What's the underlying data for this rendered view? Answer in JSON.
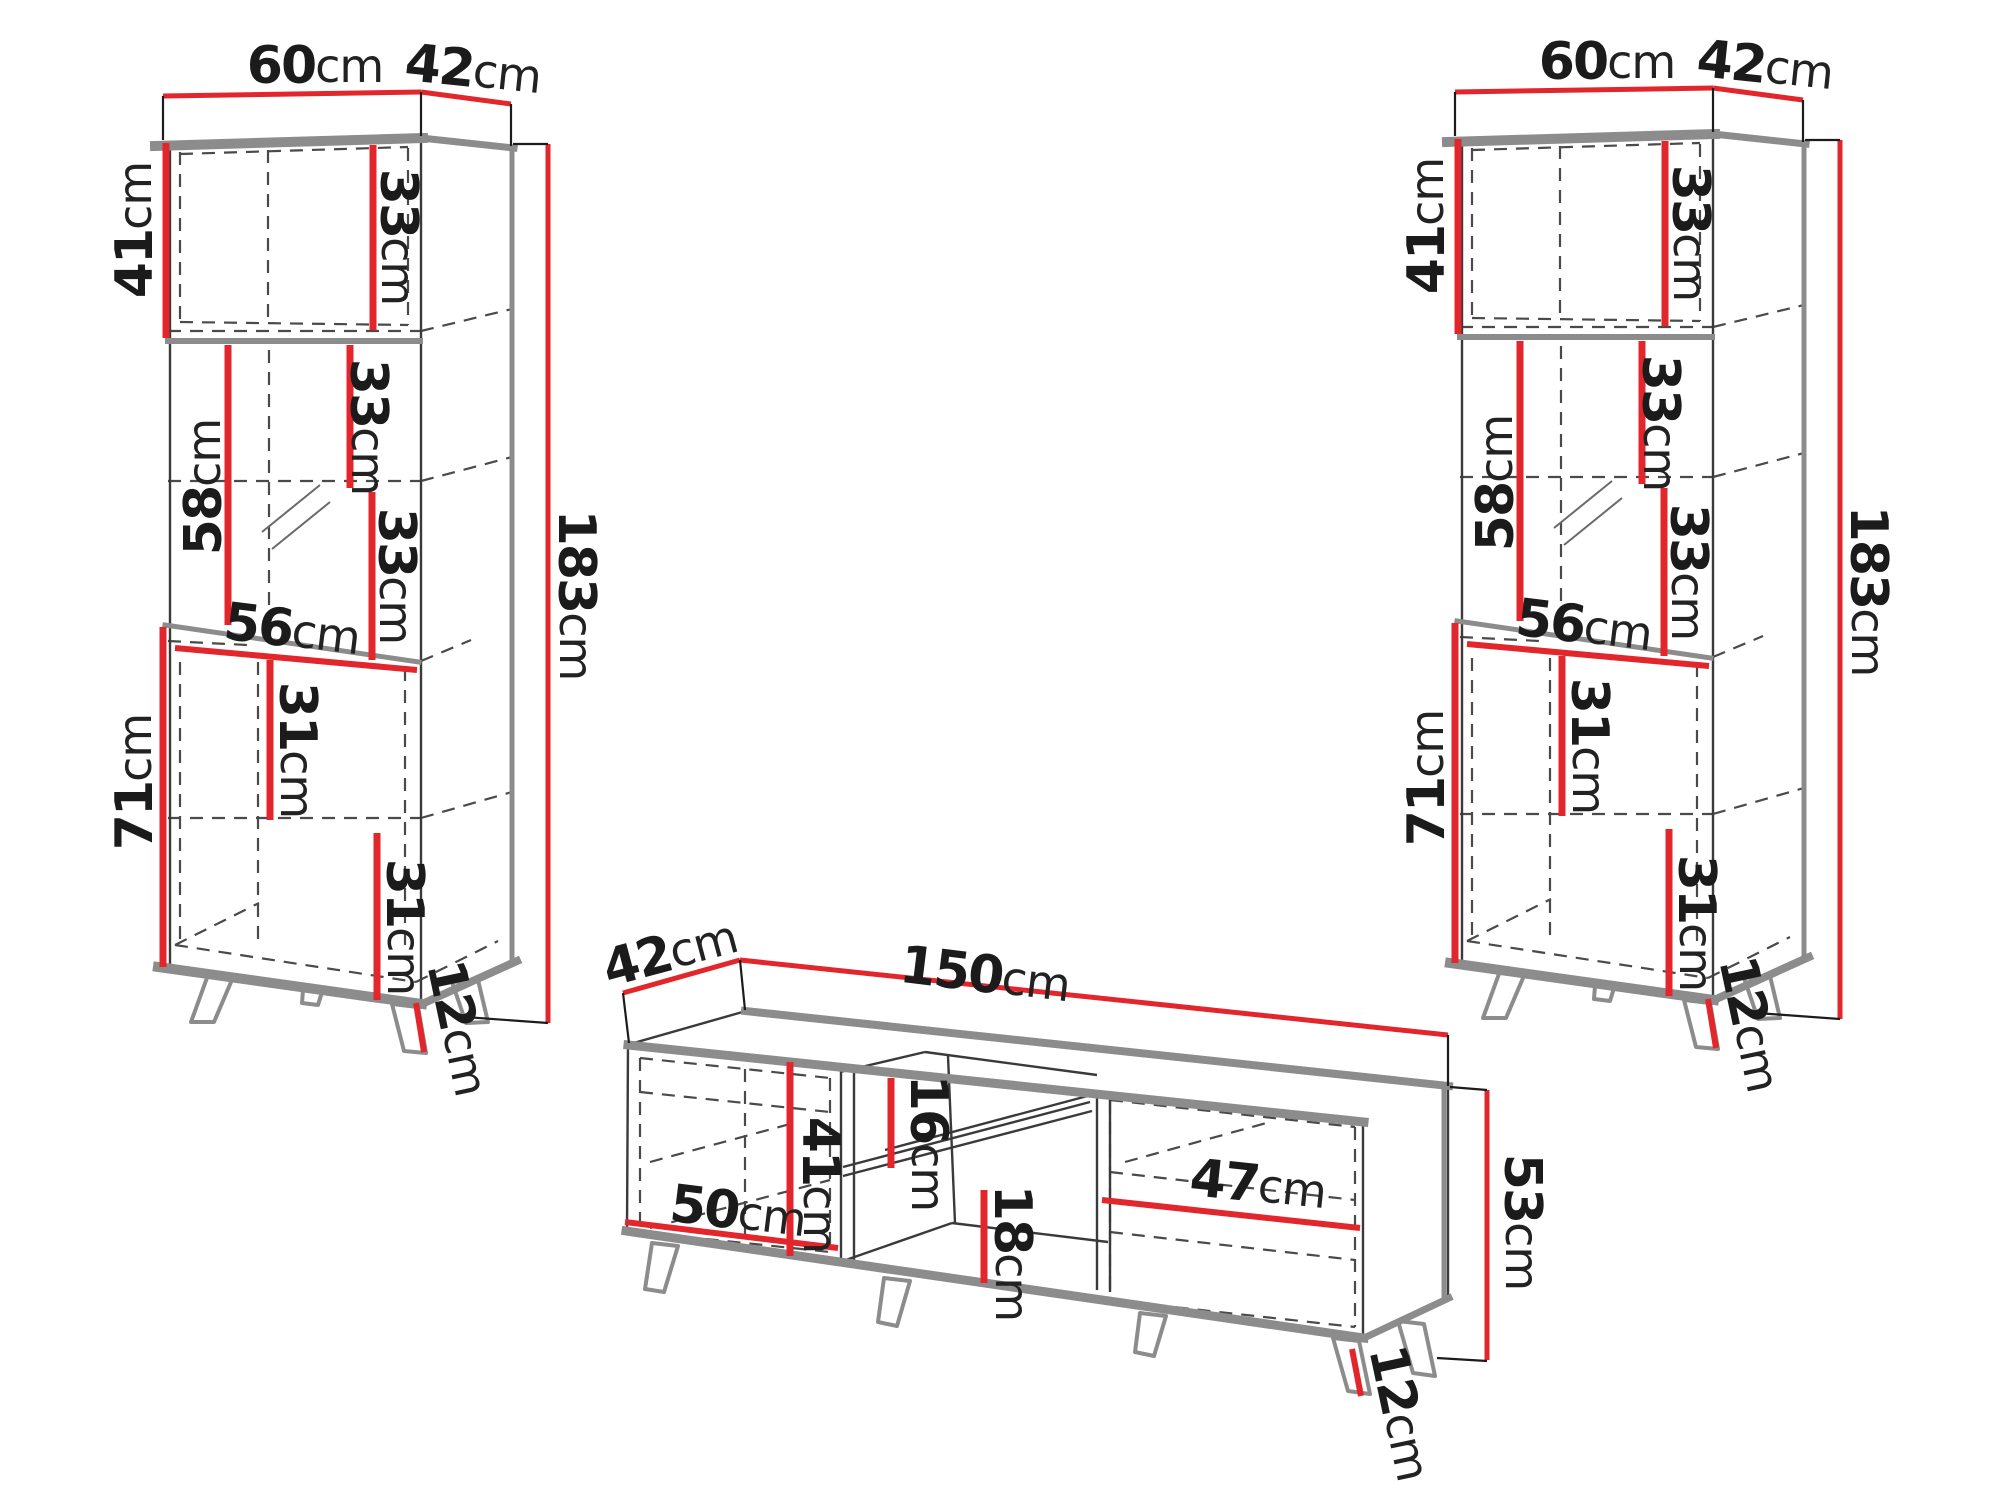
{
  "diagram": {
    "type": "furniture-dimension-drawing",
    "background": "#ffffff",
    "colors": {
      "dimension_line": "#e2262c",
      "label_text": "#1b1b1b",
      "panel_edge": "#8c8c8c",
      "outline": "#3a3a3a"
    }
  },
  "cabinets": [
    {
      "dim_width": {
        "value": "60",
        "unit": "cm"
      },
      "dim_depth": {
        "value": "42",
        "unit": "cm"
      },
      "dim_top_section_height": {
        "value": "41",
        "unit": "cm"
      },
      "dim_top_shelf_spacing": {
        "value": "33",
        "unit": "cm"
      },
      "dim_display_upper_spacing": {
        "value": "33",
        "unit": "cm"
      },
      "dim_display_lower_spacing": {
        "value": "33",
        "unit": "cm"
      },
      "dim_display_door_height": {
        "value": "58",
        "unit": "cm"
      },
      "dim_inner_width": {
        "value": "56",
        "unit": "cm"
      },
      "dim_lower_section_height": {
        "value": "71",
        "unit": "cm"
      },
      "dim_lower_upper_spacing": {
        "value": "31",
        "unit": "cm"
      },
      "dim_lower_lower_spacing": {
        "value": "31",
        "unit": "cm"
      },
      "dim_leg_height": {
        "value": "12",
        "unit": "cm"
      },
      "dim_total_height": {
        "value": "183",
        "unit": "cm"
      }
    },
    {
      "dim_width": {
        "value": "60",
        "unit": "cm"
      },
      "dim_depth": {
        "value": "42",
        "unit": "cm"
      },
      "dim_top_section_height": {
        "value": "41",
        "unit": "cm"
      },
      "dim_top_shelf_spacing": {
        "value": "33",
        "unit": "cm"
      },
      "dim_display_upper_spacing": {
        "value": "33",
        "unit": "cm"
      },
      "dim_display_lower_spacing": {
        "value": "33",
        "unit": "cm"
      },
      "dim_display_door_height": {
        "value": "58",
        "unit": "cm"
      },
      "dim_inner_width": {
        "value": "56",
        "unit": "cm"
      },
      "dim_lower_section_height": {
        "value": "71",
        "unit": "cm"
      },
      "dim_lower_upper_spacing": {
        "value": "31",
        "unit": "cm"
      },
      "dim_lower_lower_spacing": {
        "value": "31",
        "unit": "cm"
      },
      "dim_leg_height": {
        "value": "12",
        "unit": "cm"
      },
      "dim_total_height": {
        "value": "183",
        "unit": "cm"
      }
    }
  ],
  "tv_stand": {
    "dim_depth": {
      "value": "42",
      "unit": "cm"
    },
    "dim_width": {
      "value": "150",
      "unit": "cm"
    },
    "dim_left_door_width": {
      "value": "50",
      "unit": "cm"
    },
    "dim_left_section_height": {
      "value": "41",
      "unit": "cm"
    },
    "dim_niche_upper_height": {
      "value": "16",
      "unit": "cm"
    },
    "dim_niche_lower_height": {
      "value": "18",
      "unit": "cm"
    },
    "dim_right_door_width": {
      "value": "47",
      "unit": "cm"
    },
    "dim_height": {
      "value": "53",
      "unit": "cm"
    },
    "dim_leg_height": {
      "value": "12",
      "unit": "cm"
    }
  }
}
